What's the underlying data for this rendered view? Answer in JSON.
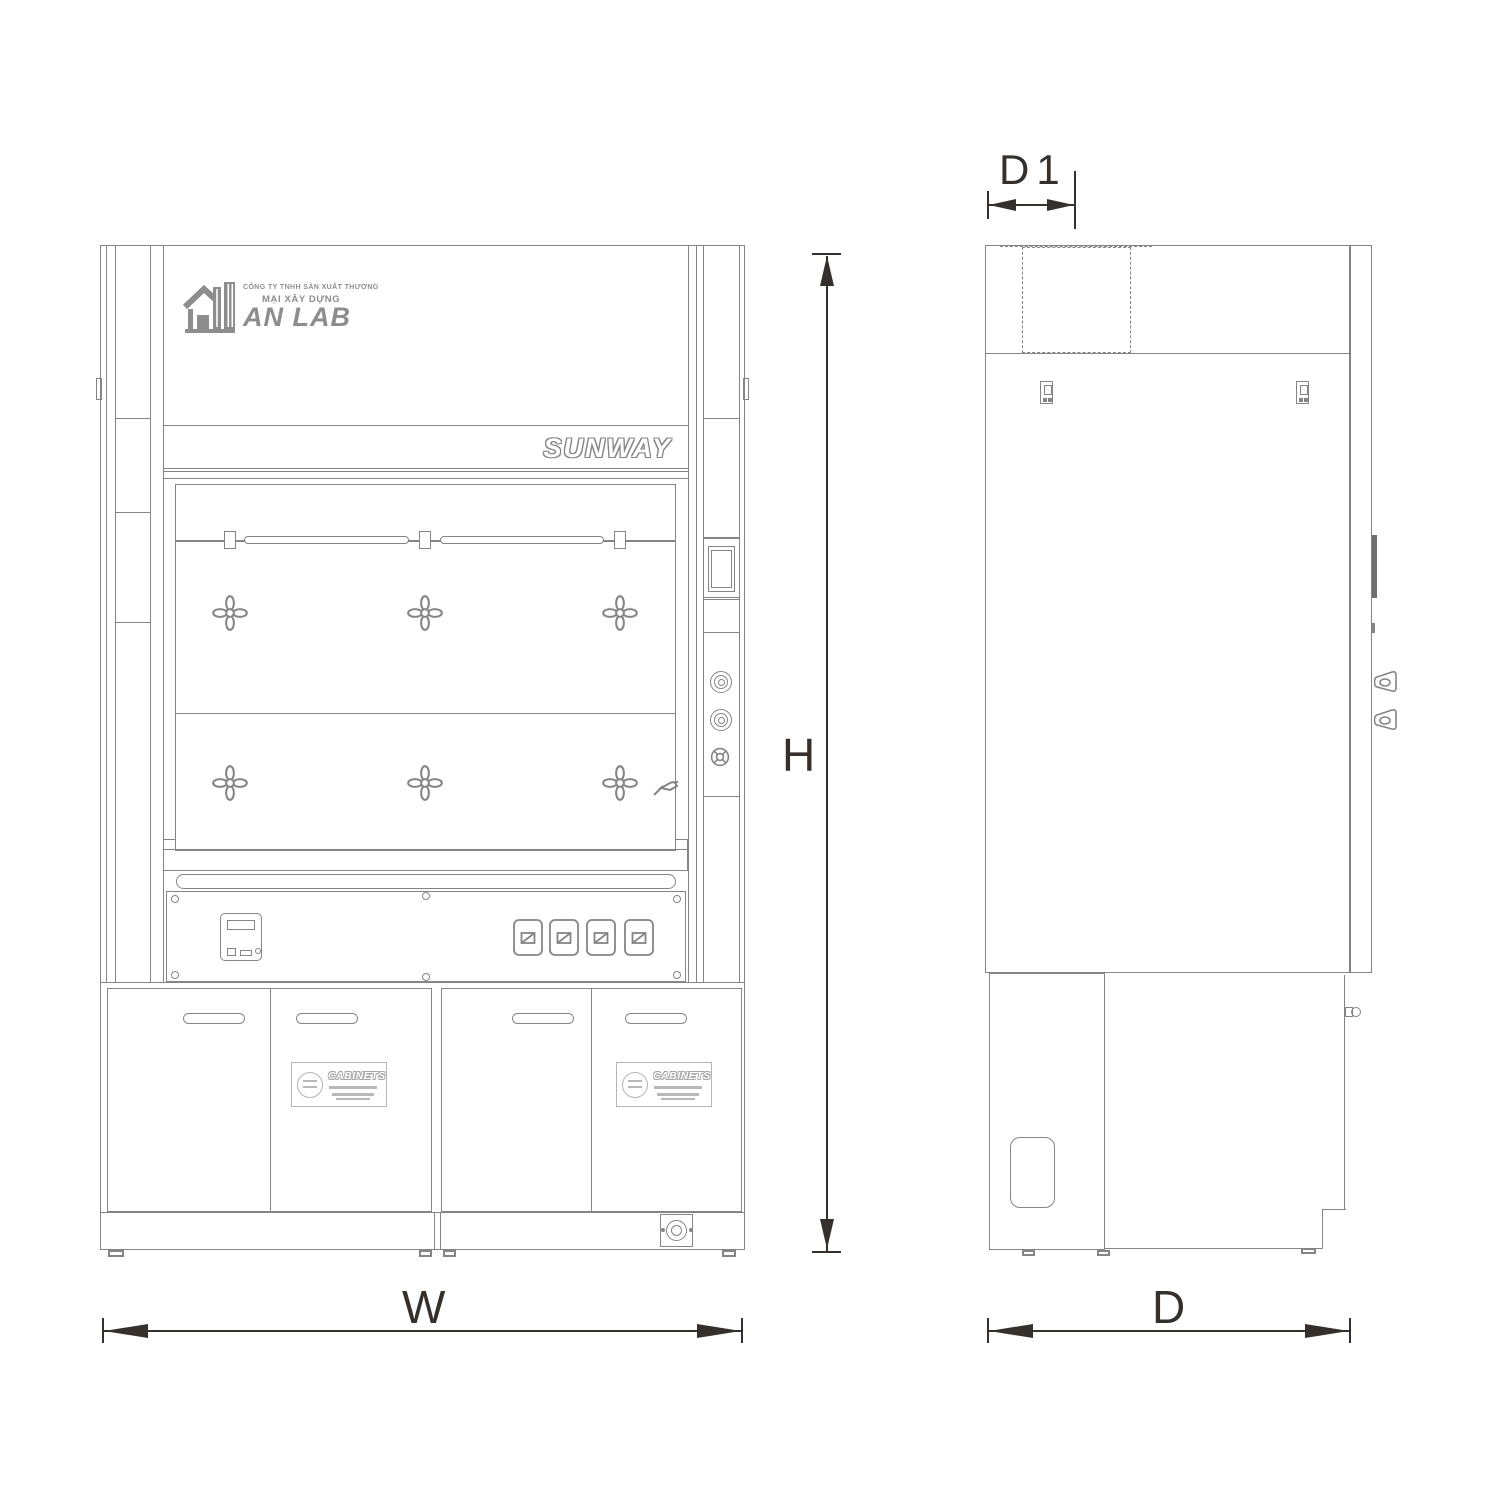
{
  "logo": {
    "company_line1": "CÔNG TY TNHH SẢN XUẤT THƯƠNG",
    "company_line2": "MẠI XÂY DỰNG",
    "brand": "AN LAB"
  },
  "front_view": {
    "brand_plate": "SUNWAY",
    "cabinet_label_title": "CABINETS"
  },
  "dimensions": {
    "width": "W",
    "height": "H",
    "depth": "D",
    "top_depth": "D1"
  },
  "colors": {
    "line": "#858585",
    "lineLight": "#b5b5b5",
    "dimension": "#35302c",
    "logo": "#8d8d8d",
    "slotFill": "#6f6f6f"
  },
  "icons": [
    "anlab-building-logo-icon",
    "valve-handle-icon",
    "faucet-icon",
    "display-panel",
    "control-knob-icon",
    "gas-valve-icon",
    "power-socket-icon",
    "rocker-switch-icon",
    "door-handle",
    "cabinets-label-emblem-icon",
    "drain-connector-icon",
    "exhaust-duct-dashed-outline",
    "hinge-bracket-icon",
    "side-latch-handle-icon",
    "leveling-foot"
  ]
}
